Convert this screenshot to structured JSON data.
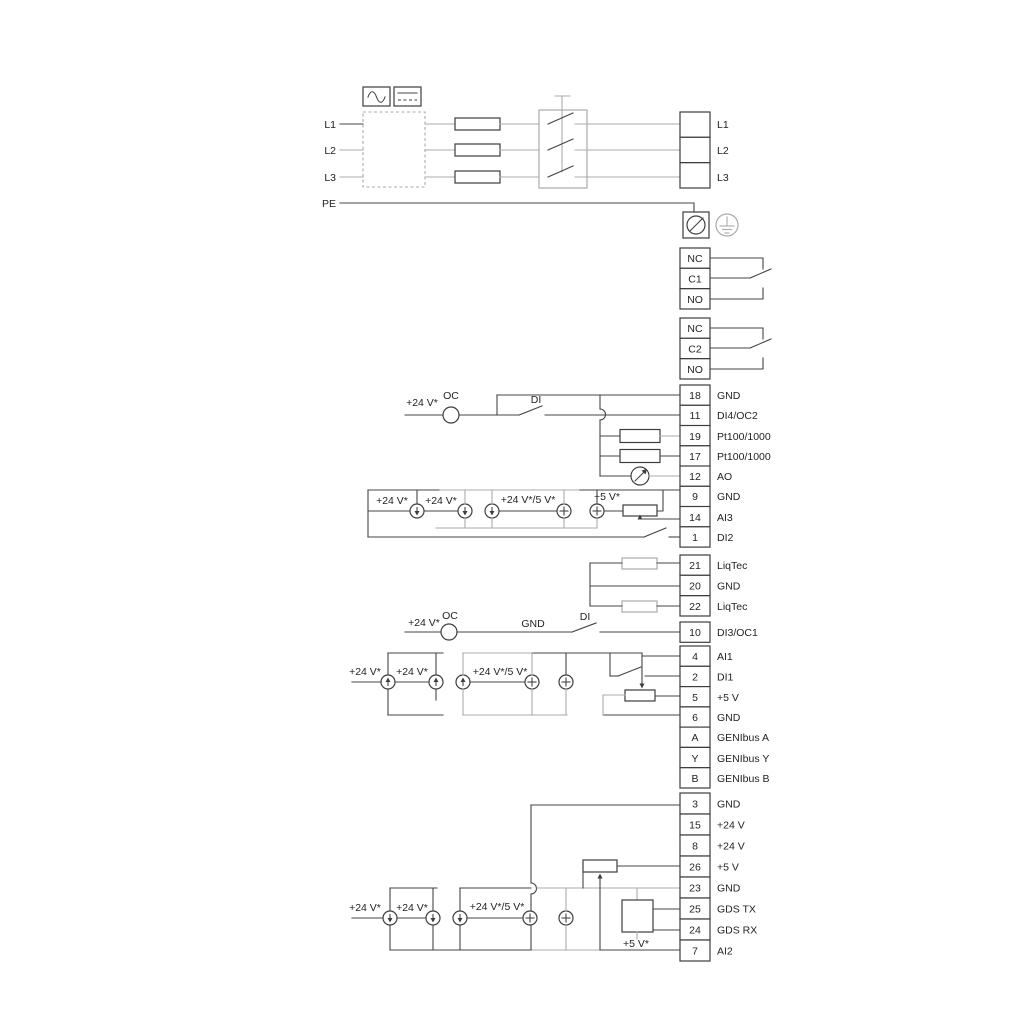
{
  "labels": {
    "v24": "+24 V*",
    "v24_5": "+24 V*/5 V*",
    "v5": "+5 V*",
    "oc": "OC",
    "di": "DI",
    "gnd": "GND"
  },
  "power": {
    "inputs": [
      "L1",
      "L2",
      "L3",
      "PE"
    ],
    "outputs": [
      "L1",
      "L2",
      "L3"
    ]
  },
  "relays": [
    {
      "terminals": [
        "NC",
        "C1",
        "NO"
      ]
    },
    {
      "terminals": [
        "NC",
        "C2",
        "NO"
      ]
    }
  ],
  "groups": {
    "io1": [
      {
        "num": "18",
        "label": "GND"
      },
      {
        "num": "11",
        "label": "DI4/OC2"
      },
      {
        "num": "19",
        "label": "Pt100/1000"
      },
      {
        "num": "17",
        "label": "Pt100/1000"
      },
      {
        "num": "12",
        "label": "AO"
      },
      {
        "num": "9",
        "label": "GND"
      },
      {
        "num": "14",
        "label": "AI3"
      },
      {
        "num": "1",
        "label": "DI2"
      }
    ],
    "liqtec": [
      {
        "num": "21",
        "label": "LiqTec"
      },
      {
        "num": "20",
        "label": "GND"
      },
      {
        "num": "22",
        "label": "LiqTec"
      }
    ],
    "di3": [
      {
        "num": "10",
        "label": "DI3/OC1"
      }
    ],
    "io2": [
      {
        "num": "4",
        "label": "AI1"
      },
      {
        "num": "2",
        "label": "DI1"
      },
      {
        "num": "5",
        "label": "+5 V"
      },
      {
        "num": "6",
        "label": "GND"
      },
      {
        "num": "A",
        "label": "GENIbus A"
      },
      {
        "num": "Y",
        "label": "GENIbus Y"
      },
      {
        "num": "B",
        "label": "GENIbus B"
      }
    ],
    "io3": [
      {
        "num": "3",
        "label": "GND"
      },
      {
        "num": "15",
        "label": "+24 V"
      },
      {
        "num": "8",
        "label": "+24 V"
      },
      {
        "num": "26",
        "label": "+5 V"
      },
      {
        "num": "23",
        "label": "GND"
      },
      {
        "num": "25",
        "label": "GDS TX"
      },
      {
        "num": "24",
        "label": "GDS RX"
      },
      {
        "num": "7",
        "label": "AI2"
      }
    ]
  },
  "colors": {
    "wire": "#454545",
    "alt": "#a9abad",
    "background": "#ffffff"
  }
}
